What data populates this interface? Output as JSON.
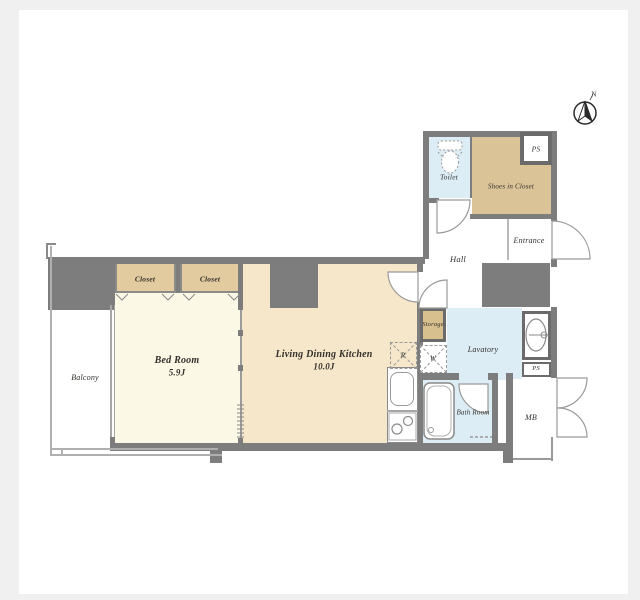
{
  "colors": {
    "wall": "#7d7d7d",
    "closet_tan": "#e2cb9e",
    "shoes_closet_tan": "#d9c397",
    "storage_tan": "#d8bf8e",
    "bedroom_cream": "#fbf8e6",
    "ldk_cream": "#f6e7ca",
    "wet_area_blue": "#dcedf5",
    "page_margin_gray": "#f0f0f0",
    "canvas_white": "#ffffff"
  },
  "compass": {
    "north_label": "N"
  },
  "rooms": {
    "balcony": {
      "label": "Balcony"
    },
    "bedroom": {
      "label": "Bed Room",
      "size": "5.9J"
    },
    "living_dining_kitchen": {
      "label": "Living Dining Kitchen",
      "size": "10.0J"
    },
    "closet_left": {
      "label": "Closet"
    },
    "closet_right": {
      "label": "Closet"
    },
    "toilet": {
      "label": "Toilet"
    },
    "shoes_in_closet": {
      "label": "Shoes in Closet"
    },
    "ps_upper": {
      "label": "PS"
    },
    "entrance": {
      "label": "Entrance"
    },
    "hall": {
      "label": "Hall"
    },
    "storage": {
      "label": "Storage"
    },
    "refrigerator_space": {
      "label": "R"
    },
    "washer_space": {
      "label": "W"
    },
    "lavatory": {
      "label": "Lavatory"
    },
    "ps_lower": {
      "label": "PS"
    },
    "bath_room": {
      "label": "Bath Room"
    },
    "meter_box": {
      "label": "MB"
    }
  }
}
